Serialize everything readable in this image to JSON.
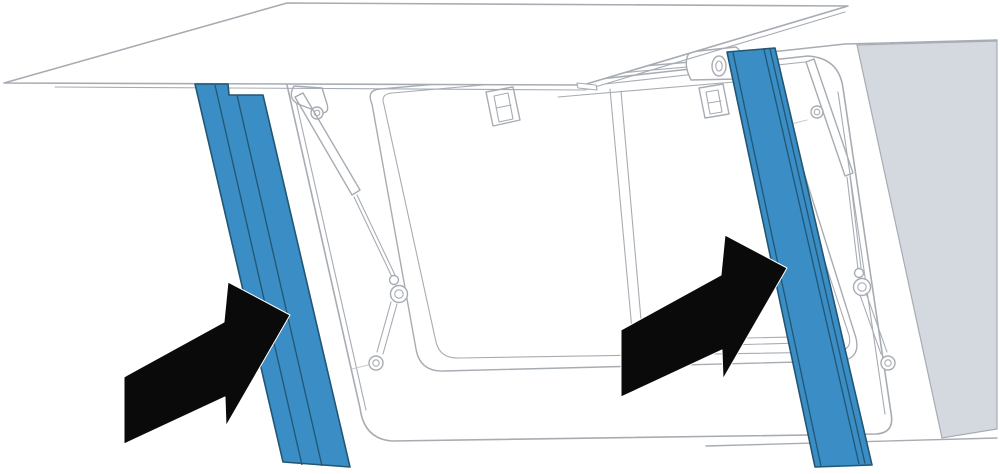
{
  "figure": {
    "kind": "appliance-installation-illustration",
    "description": "Line-art installation drawing of a wall appliance with its flap door open upward; two blue side trim strips are highlighted and two large black arrows show where they are inserted.",
    "canvas": {
      "width": 1000,
      "height": 474
    },
    "colors": {
      "background": "#ffffff",
      "outline": "#a7acb3",
      "outline-soft": "#c6cad0",
      "white": "#ffffff",
      "highlight": "#3a8dc5",
      "highlight-dark": "#225672",
      "black": "#0a0a0a",
      "panel": "#d4d9df"
    },
    "parts": {
      "flap-door": "open flap door (lid) raised above the housing",
      "housing": "appliance housing with rounded front frame",
      "door-opening": "front opening rim with rounded corners",
      "inner-glass": "inner glass / cavity edge",
      "latch-left": "left door latch",
      "latch-right": "right door latch",
      "gas-strut-left": "left gas strut with ball-joint end",
      "gas-strut-right": "right gas strut with ball-joint end",
      "side-panel": "shaded right side panel",
      "trim-strip-left": "left trim strip highlighted in blue",
      "trim-strip-right": "right trim strip highlighted in blue",
      "arrow-left": "black arrow pointing at left trim strip",
      "arrow-right": "black arrow pointing at right trim strip"
    }
  }
}
